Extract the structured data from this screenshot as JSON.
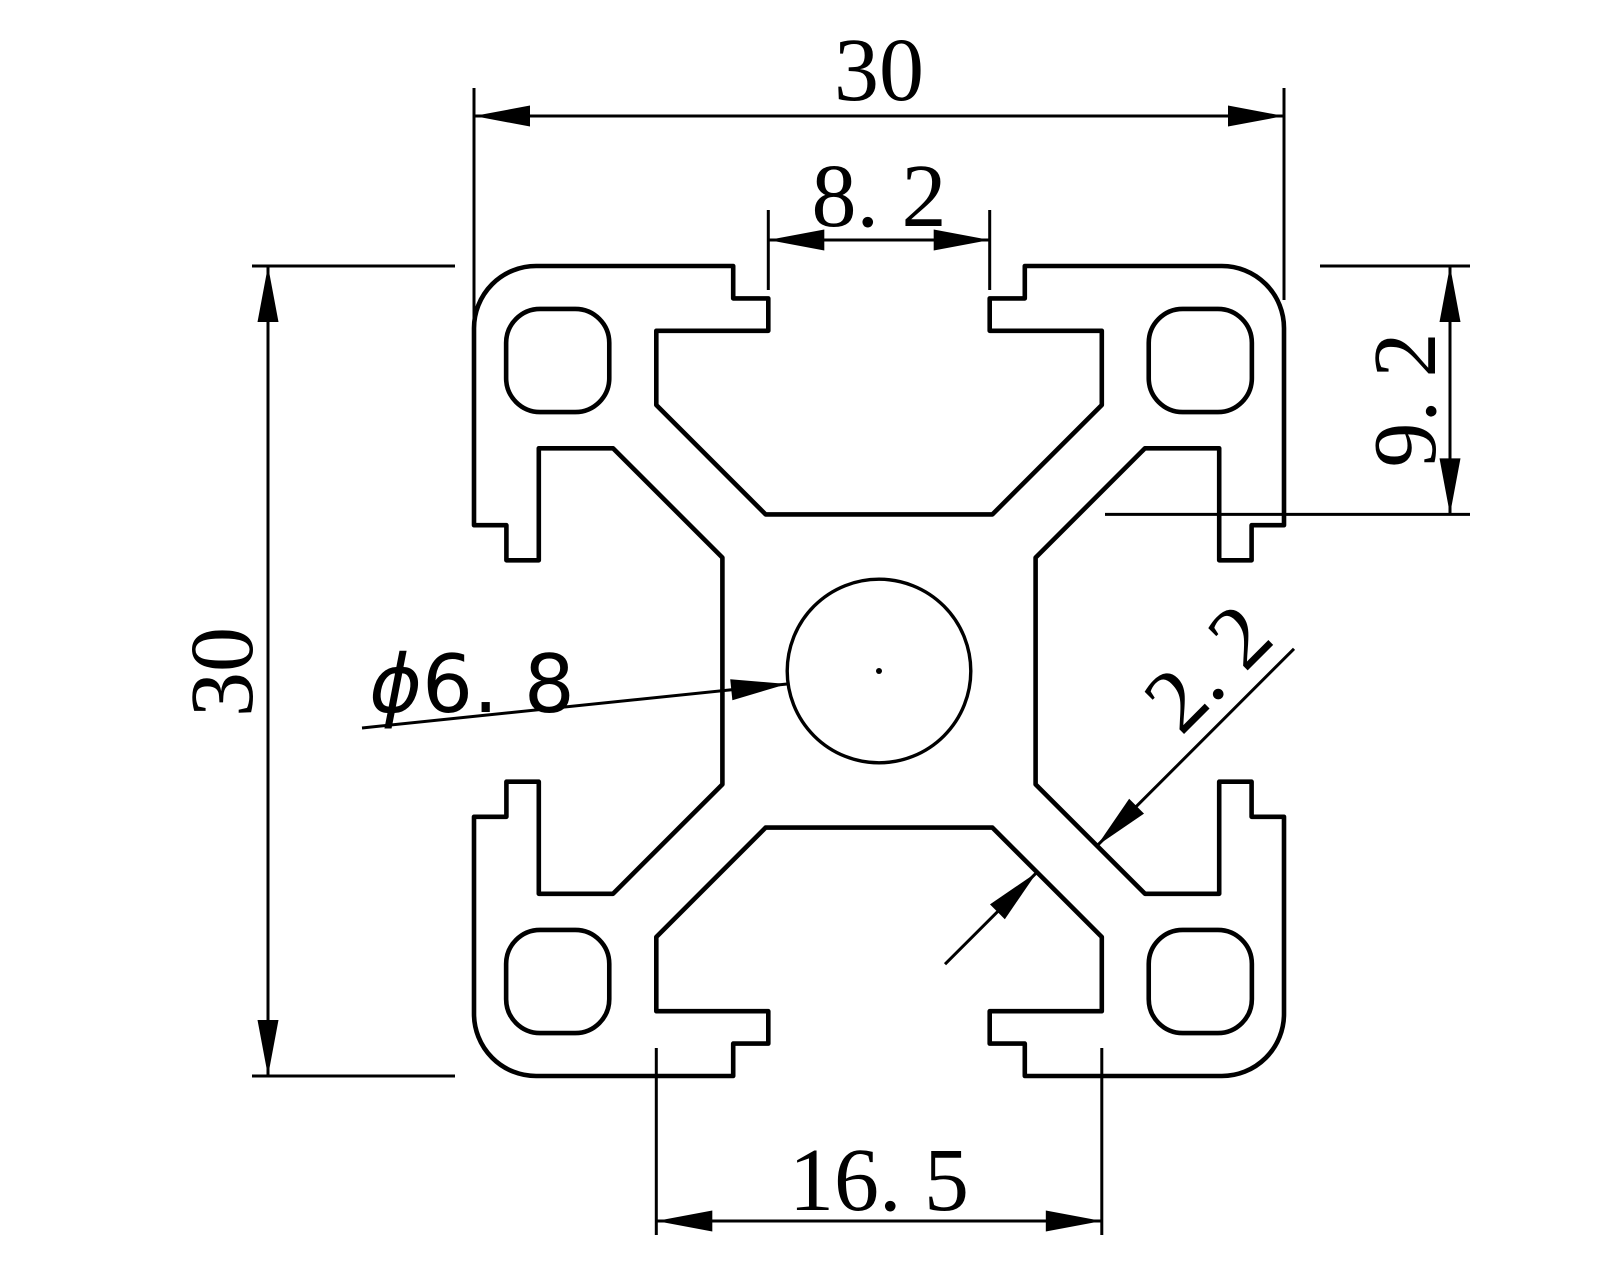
{
  "drawing": {
    "type": "technical-drawing",
    "subject": "3030 aluminium extrusion T-slot profile cross-section",
    "background_color": "#ffffff",
    "line_color": "#000000",
    "profile_mm": {
      "outer_width": 30,
      "outer_height": 30,
      "slot_opening": 8.2,
      "slot_depth": 9.2,
      "slot_chamber_width": 16.5,
      "center_hole_diameter": 6.8,
      "web_thickness": 2.2
    },
    "dimensions": {
      "top_width": {
        "label": "30"
      },
      "slot_opening": {
        "label": "8. 2"
      },
      "slot_depth": {
        "label": "9. 2"
      },
      "left_height": {
        "label": "30"
      },
      "chamber_width": {
        "label": "16. 5"
      },
      "center_hole": {
        "symbol": "ϕ",
        "value": "6. 8"
      },
      "web_thickness": {
        "label": "2. 2"
      }
    }
  }
}
